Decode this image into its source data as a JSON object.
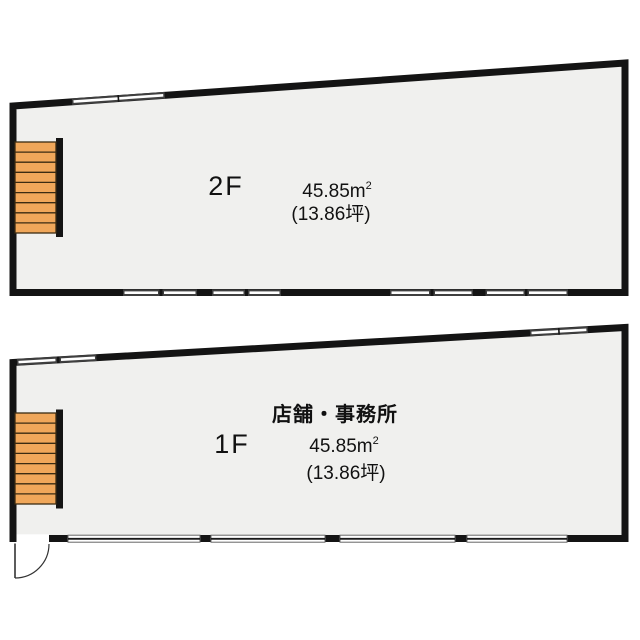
{
  "plan_title": "2-story floor plan",
  "colors": {
    "wall": "#141414",
    "floor_fill": "#f0f0ee",
    "stair_fill": "#f0a75a",
    "stair_line": "#3a2b12",
    "window_dark": "#3f3f3f",
    "page_background": "#ffffff"
  },
  "floor_2f": {
    "floor_label": "2F",
    "area_value": "45.85",
    "area_unit": "m",
    "area_sup": "2",
    "area_tsubo": "(13.86坪)"
  },
  "floor_1f": {
    "usage_label": "店舗・事務所",
    "floor_label": "1F",
    "area_value": "45.85",
    "area_unit": "m",
    "area_sup": "2",
    "area_tsubo": "(13.86坪)"
  }
}
